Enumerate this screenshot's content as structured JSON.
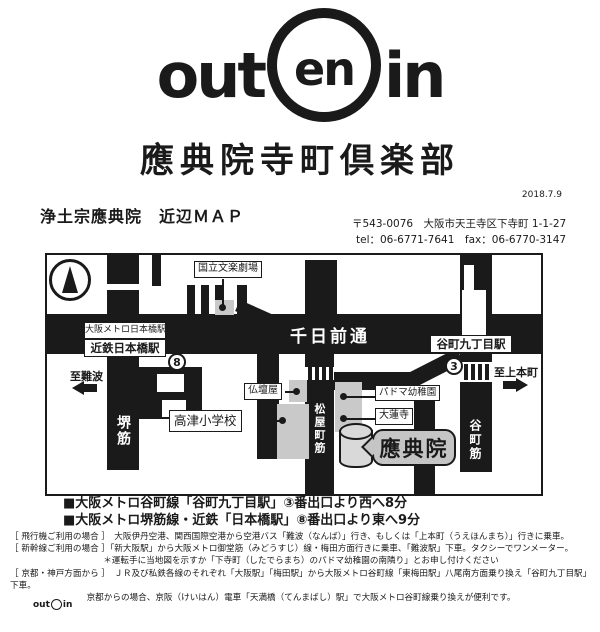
{
  "colors": {
    "ink": "#1a1a1a",
    "building_gray": "#c9c9c9",
    "bubble_gray": "#c5c5c5"
  },
  "header": {
    "logo_out": "out",
    "logo_en": "en",
    "logo_in": "in",
    "title": "應典院寺町倶楽部",
    "date": "2018.7.9",
    "map_heading": "浄土宗應典院　近辺ＭＡＰ",
    "postal_address": "〒543-0076　大阪市天王寺区下寺町 1-1-27",
    "tel_fax": "tel：06-6771-7641　fax：06-6770-3147"
  },
  "map": {
    "roads": {
      "senichimae": "千日前通",
      "sakaisuji": "堺筋",
      "matsuyamachisuji": "松屋町筋",
      "tanimachisuji": "谷町筋"
    },
    "stations": {
      "metro_nipponbashi": "大阪メトロ日本橋駅",
      "kintetsu_nipponbashi": "近鉄日本橋駅",
      "tanimachi9": "谷町九丁目駅",
      "exit8": "8",
      "exit3": "3"
    },
    "places": {
      "bunraku": "国立文楽劇場",
      "butsudanya": "仏壇屋",
      "kozu_elementary": "高津小学校",
      "padoma": "パドマ幼稚園",
      "dairenji": "大蓮寺",
      "outenin": "應典院"
    },
    "directions": {
      "to_namba": "至難波",
      "to_uehommachi": "至上本町"
    }
  },
  "access": {
    "bullet1": "■大阪メトロ谷町線「谷町九丁目駅」③番出口より西へ8分",
    "bullet2": "■大阪メトロ堺筋線・近鉄「日本橋駅」⑧番出口より東へ9分",
    "notes": [
      "［ 飛行機ご利用の場合 ］　大阪伊丹空港、関西国際空港から空港バス「難波（なんば）」行き、もしくは「上本町（うえほんまち）」行きに乗車。",
      "［ 新幹線ご利用の場合 ］「新大阪駅」から大阪メトロ御堂筋（みどうすじ）線・梅田方面行きに乗車、「難波駅」下車。タクシーでワンメーター。",
      "＊運転手に当地図を示すか「下寺町（したでらまち）のパドマ幼稚園の南隣り」とお申し付けください",
      "［ 京都・神戸方面から ］　ＪＲ及び私鉄各線のそれぞれ「大阪駅」「梅田駅」から大阪メトロ谷町線「東梅田駅」八尾南方面乗り換え「谷町九丁目駅」下車。",
      "京都からの場合、京阪（けいはん）電車「天満橋（てんまばし）駅」で大阪メトロ谷町線乗り換えが便利です。"
    ]
  },
  "footer": {
    "logo_out": "out",
    "logo_in": "in"
  }
}
